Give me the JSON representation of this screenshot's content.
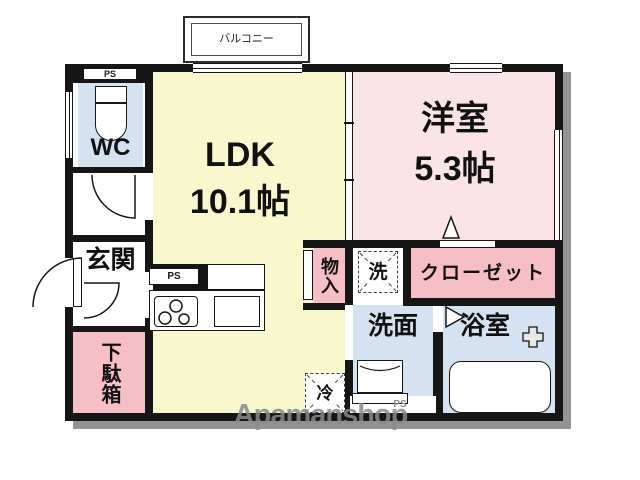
{
  "plan": {
    "balcony_label": "バルコニー",
    "rooms": {
      "ldk": {
        "name": "LDK",
        "size": "10.1帖"
      },
      "western": {
        "name": "洋室",
        "size": "5.3帖"
      },
      "wc": {
        "name": "WC"
      },
      "entrance": {
        "name": "玄関"
      },
      "shoe_box": {
        "name": "下駄箱"
      },
      "storage": {
        "name": "物入"
      },
      "closet": {
        "name": "クローゼット"
      },
      "washroom": {
        "name": "洗面"
      },
      "bathroom": {
        "name": "浴室"
      }
    },
    "equipment": {
      "washer_space": "洗",
      "fridge_space": "冷"
    },
    "pipe_spaces": {
      "top_left": "PS",
      "kitchen": "PS",
      "bottom": "PS"
    },
    "watermark": "Apamanshop"
  },
  "colors": {
    "wall": "#161616",
    "ldk_fill": "#F9F7CD",
    "western_room_fill": "#FBE4E7",
    "storage_fill": "#F5BFC5",
    "wet_area_fill": "#D5E2F2",
    "shadow": "#949494",
    "watermark_gray": "#8A8A8A"
  }
}
